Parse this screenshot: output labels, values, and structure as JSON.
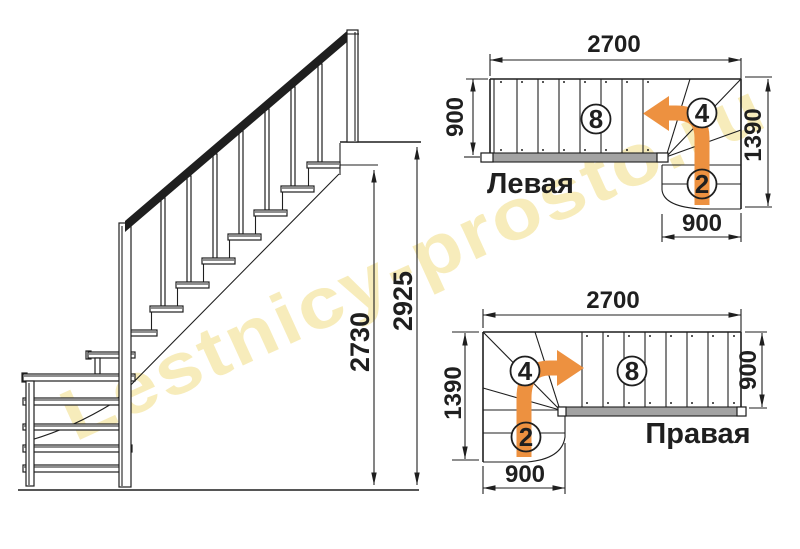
{
  "watermark": {
    "text": "Lestnicy-prosto.ru"
  },
  "colors": {
    "line": "#1f1f1f",
    "arrow": "#ED9140",
    "watermark": "#F2E08E",
    "strip": "#A3A3A3",
    "bg": "#FFFFFF"
  },
  "side_view": {
    "dim_total_height": "2925",
    "dim_structure_height": "2730"
  },
  "plans": {
    "left": {
      "title": "Левая",
      "dim_top": "2700",
      "dim_left": "900",
      "dim_right": "1390",
      "dim_bottom": "900",
      "steps_straight": "8",
      "steps_winder": "4",
      "steps_bottom": "2"
    },
    "right": {
      "title": "Правая",
      "dim_top": "2700",
      "dim_left": "1390",
      "dim_right": "900",
      "dim_bottom": "900",
      "steps_straight": "8",
      "steps_winder": "4",
      "steps_bottom": "2"
    }
  }
}
